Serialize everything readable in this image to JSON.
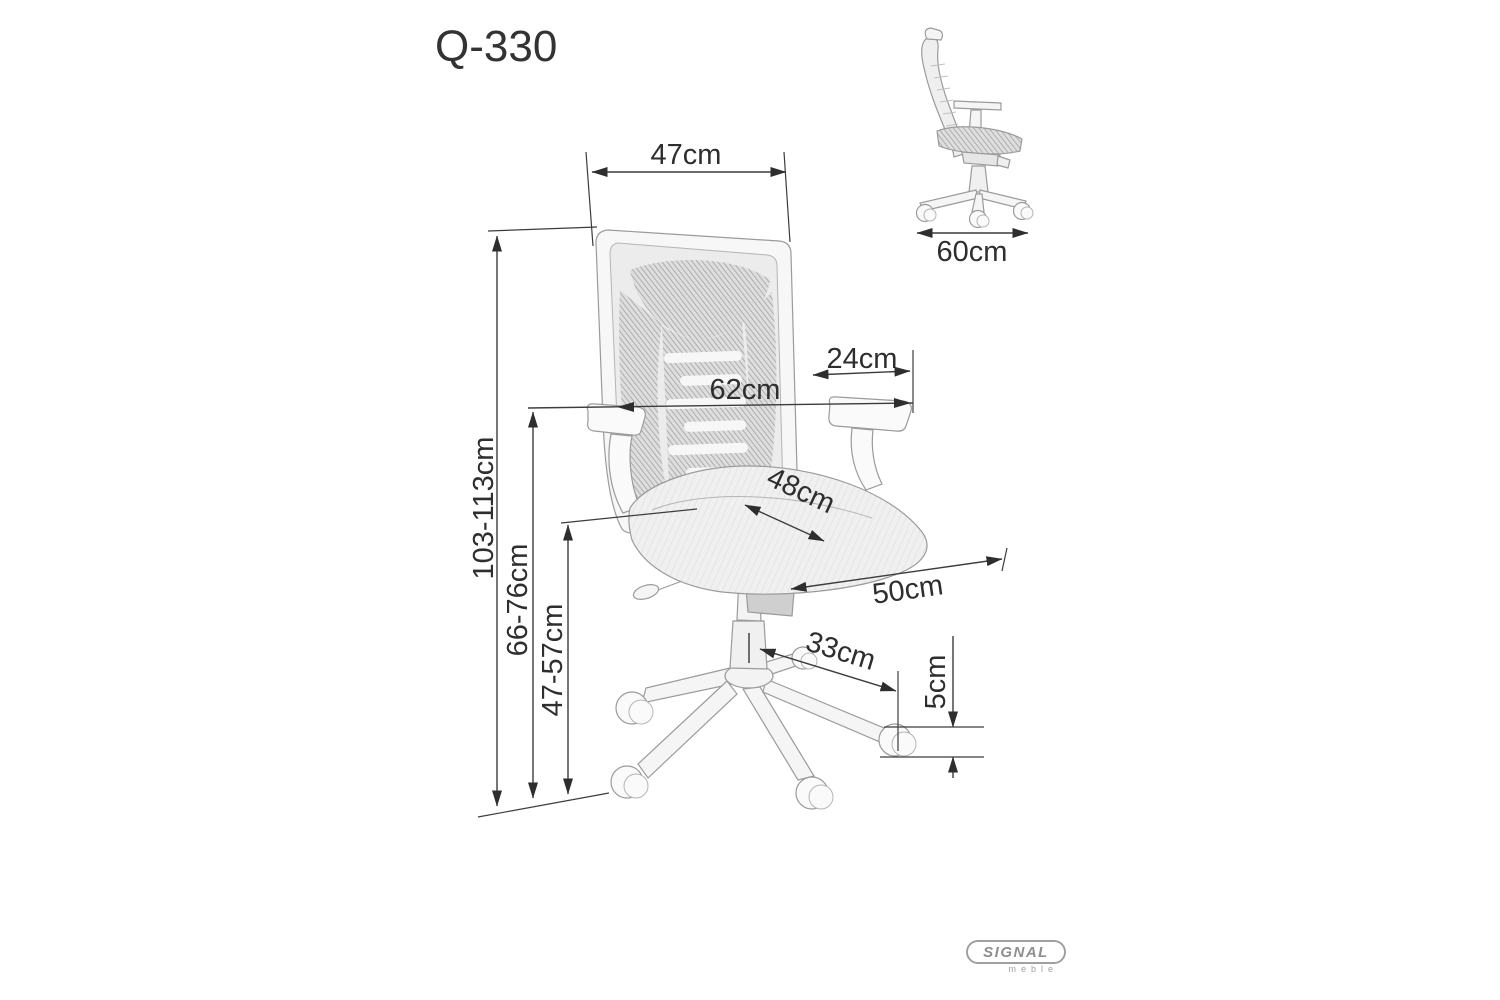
{
  "page": {
    "title": "Q-330"
  },
  "dims": {
    "back_width": "47cm",
    "overall_width": "62cm",
    "armrest_to_edge": "24cm",
    "seat_depth": "48cm",
    "seat_width": "50cm",
    "total_height": "103-113cm",
    "armrest_height": "66-76cm",
    "seat_height": "47-57cm",
    "base_leg_reach": "33cm",
    "caster_height": "5cm",
    "side_depth": "60cm"
  },
  "logo": {
    "brand": "SIGNAL",
    "sub": "meble"
  },
  "colors": {
    "dimension_lines": "#3c3c3c",
    "label_text": "#2e2e2e",
    "chair_outline": "#9b9b9b",
    "mesh_gray": "#a8a8a8",
    "logo_gray": "#9a9a9a",
    "background": "#ffffff"
  }
}
